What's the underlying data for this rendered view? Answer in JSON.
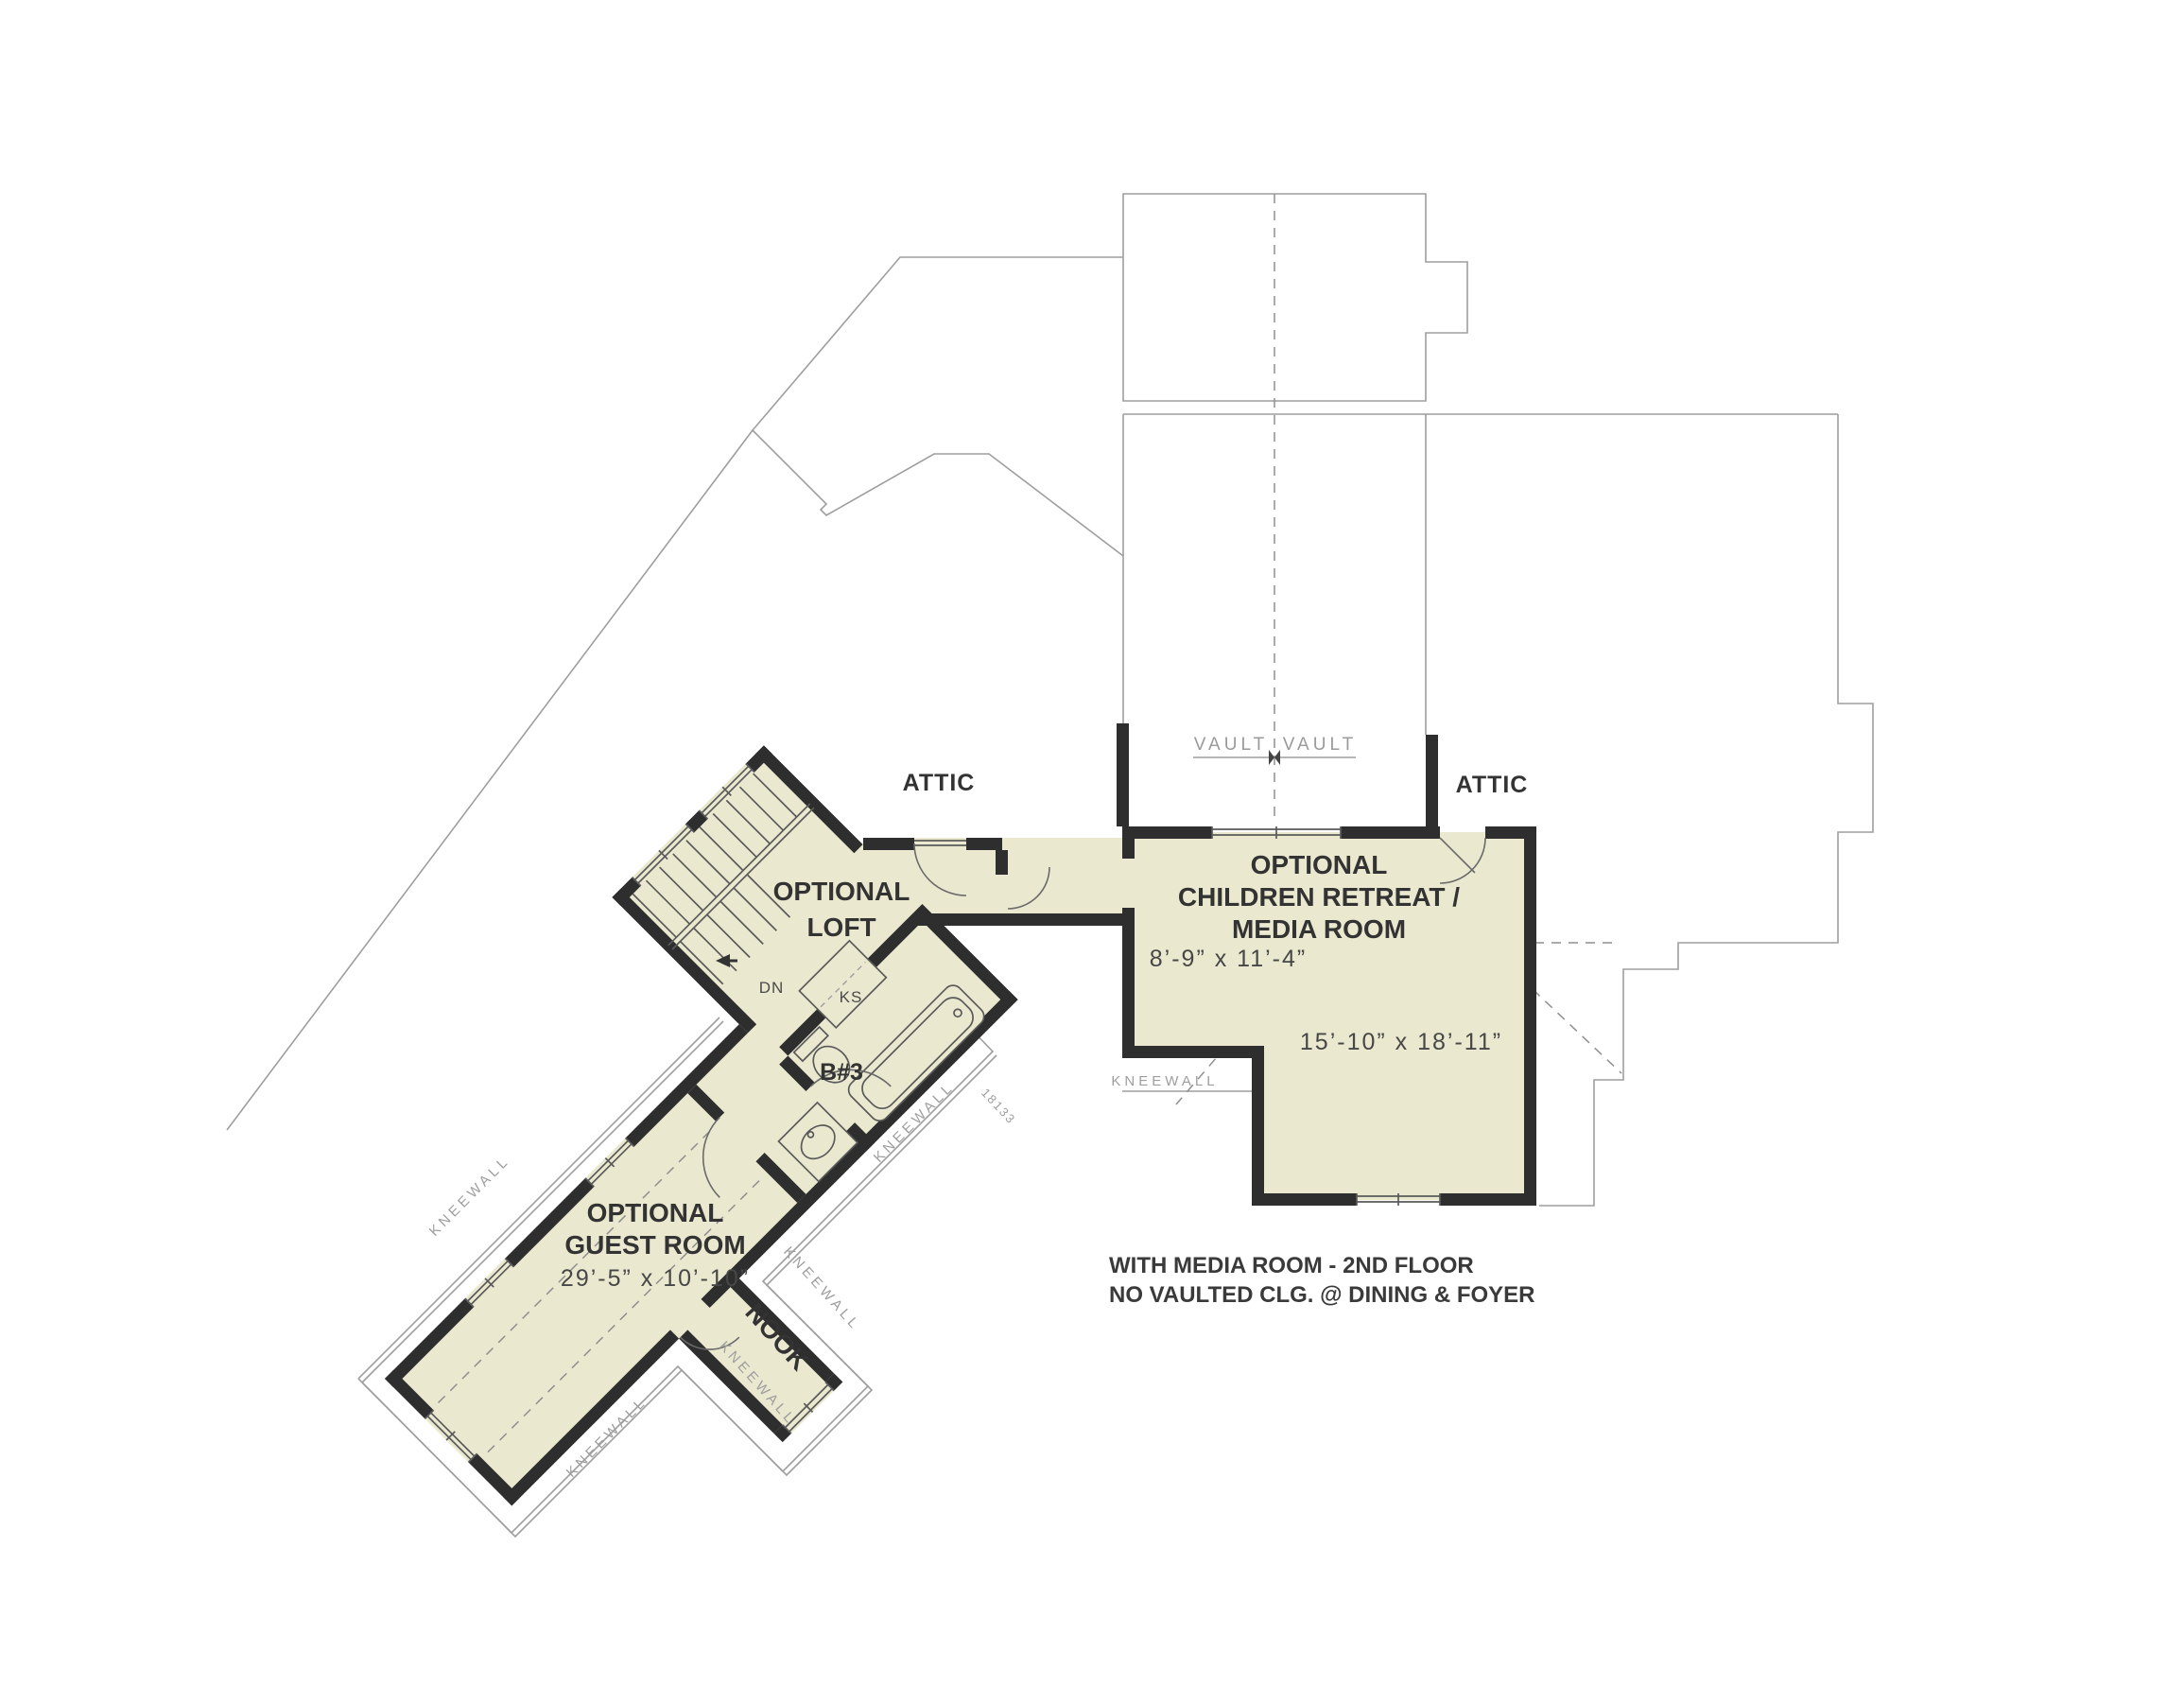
{
  "labels": {
    "attic": "ATTIC",
    "vault": "VAULT",
    "kneewall": "KNEEWALL",
    "plan_number": "18133",
    "dn": "DN",
    "ks": "KS",
    "b3": "B#3",
    "nook": "NOOK"
  },
  "rooms": {
    "loft": {
      "line1": "OPTIONAL",
      "line2": "LOFT"
    },
    "children": {
      "line1": "OPTIONAL",
      "line2": "CHILDREN RETREAT /",
      "line3": "MEDIA ROOM",
      "dim_upper": "8’-9”  x  11’-4”",
      "dim_main": "15’-10”  x  18’-11”"
    },
    "guest": {
      "line1": "OPTIONAL",
      "line2": "GUEST ROOM",
      "dim": "29’-5”  x  10’-10”"
    }
  },
  "note": {
    "line1": "WITH MEDIA ROOM -  2ND FLOOR",
    "line2": "NO VAULTED CLG. @ DINING & FOYER"
  },
  "colors": {
    "floor_fill": "#eae8cf",
    "wall": "#2e2e2e",
    "roof_outline": "#9e9e9e",
    "label_text": "#333333",
    "tech_text": "#9e9e9e"
  }
}
